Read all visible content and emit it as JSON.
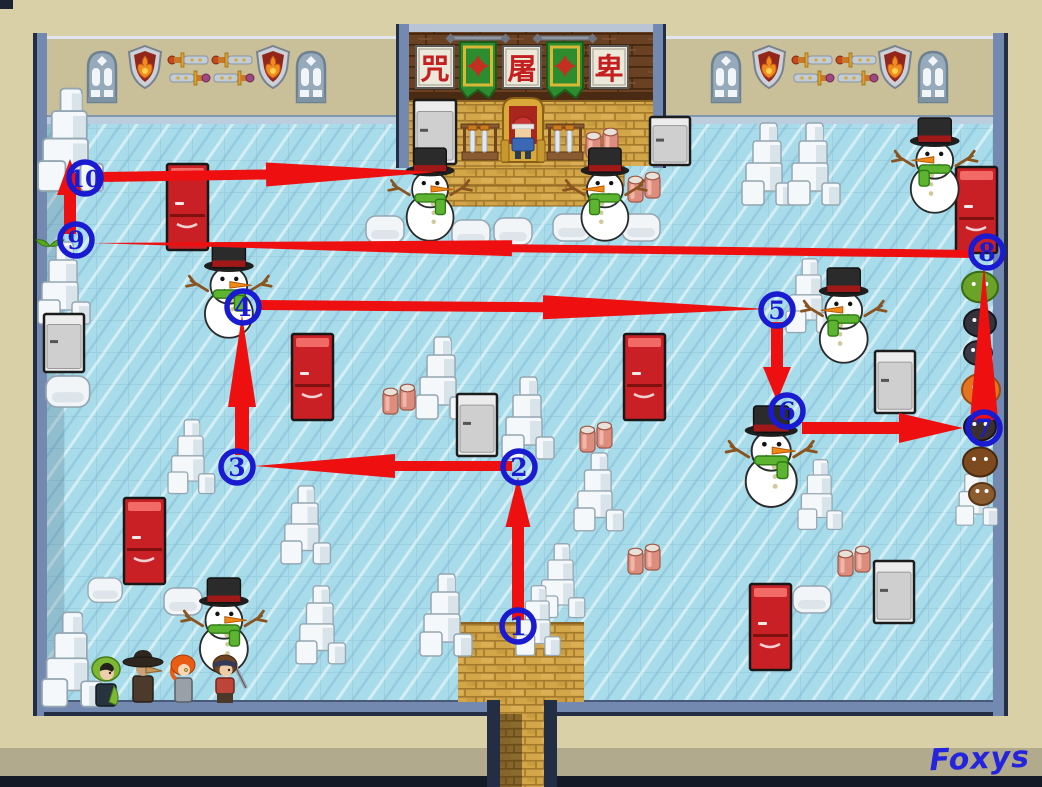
{
  "watermark": "Foxys",
  "palette": {
    "page_bg": "#d9d0a8",
    "navy": "#1c2433",
    "navy2": "#232e45",
    "wall_tan": "#c9bf98",
    "slate": "#7389b0",
    "slate_dark": "#49597a",
    "trim": "#bccede",
    "floor": "#a9dcea",
    "band_gray": "#b2aa8c",
    "route_red": "#ee1010",
    "marker_blue": "#1a1ad0",
    "watermark_blue": "#2424dd",
    "fridge_red": "#c92026",
    "ice_white": "#f4f8fa",
    "gold": "#d2a548",
    "wood": "#6b4123",
    "banner_green": "#2d8c2d",
    "scarf_green": "#5cb430"
  },
  "throne_room": {
    "signs": [
      "咒",
      "屠",
      "卑"
    ]
  },
  "wall_decor": {
    "order": [
      "window",
      "shield",
      "swords",
      "swords",
      "shield",
      "window"
    ],
    "left_x": [
      86,
      127,
      167,
      211,
      255,
      295
    ],
    "right_x": [
      710,
      751,
      791,
      835,
      877,
      917
    ],
    "y": 45
  },
  "route": {
    "color": "#ee1010",
    "marker_color": "#1a1ad0",
    "waypoints": [
      {
        "n": "1",
        "x": 518,
        "y": 626
      },
      {
        "n": "2",
        "x": 519,
        "y": 467
      },
      {
        "n": "3",
        "x": 237,
        "y": 467
      },
      {
        "n": "4",
        "x": 243,
        "y": 307
      },
      {
        "n": "5",
        "x": 777,
        "y": 310
      },
      {
        "n": "6",
        "x": 787,
        "y": 411
      },
      {
        "n": "7",
        "x": 984,
        "y": 428
      },
      {
        "n": "8",
        "x": 987,
        "y": 252
      },
      {
        "n": "9",
        "x": 76,
        "y": 240
      },
      {
        "n": "10",
        "x": 85,
        "y": 178
      }
    ],
    "segments": [
      {
        "name": "1-2",
        "x1": 518,
        "y1": 620,
        "x2": 518,
        "y2": 477,
        "w": 12,
        "hl": 50,
        "hw": 25
      },
      {
        "name": "2-3",
        "x1": 512,
        "y1": 466,
        "x2": 255,
        "y2": 466,
        "w": 10,
        "hl": 140,
        "hw": 24
      },
      {
        "name": "3-4",
        "x1": 242,
        "y1": 455,
        "x2": 242,
        "y2": 315,
        "w": 14,
        "hl": 92,
        "hw": 28
      },
      {
        "name": "4-5",
        "x1": 258,
        "y1": 305,
        "x2": 768,
        "y2": 309,
        "w": 10,
        "hl": 225,
        "hw": 24
      },
      {
        "name": "5-6",
        "x1": 777,
        "y1": 322,
        "x2": 777,
        "y2": 401,
        "w": 12,
        "hl": 34,
        "hw": 28
      },
      {
        "name": "6-7",
        "x1": 802,
        "y1": 428,
        "x2": 963,
        "y2": 428,
        "w": 12,
        "hl": 64,
        "hw": 30
      },
      {
        "name": "7-8",
        "x1": 984,
        "y1": 420,
        "x2": 984,
        "y2": 264,
        "w": 20,
        "hl": 150,
        "hw": 27
      },
      {
        "name": "8-9",
        "x1": 974,
        "y1": 254,
        "x2": 92,
        "y2": 243,
        "w": 8,
        "hl": 420,
        "hw": 16
      },
      {
        "name": "9-10",
        "x1": 70,
        "y1": 234,
        "x2": 70,
        "y2": 159,
        "w": 12,
        "hl": 36,
        "hw": 26
      },
      {
        "name": "10-end",
        "x1": 100,
        "y1": 177,
        "x2": 438,
        "y2": 172,
        "w": 10,
        "hl": 172,
        "hw": 24
      }
    ]
  },
  "scenery": {
    "snowmen": [
      [
        395,
        148,
        0.9,
        0
      ],
      [
        568,
        148,
        0.9,
        1
      ],
      [
        193,
        243,
        0.92,
        0
      ],
      [
        897,
        118,
        0.92,
        1
      ],
      [
        806,
        268,
        0.92,
        1
      ],
      [
        733,
        406,
        0.98,
        0
      ],
      [
        188,
        578,
        0.92,
        0
      ]
    ],
    "ice_pillars": [
      [
        38,
        86,
        1.25
      ],
      [
        38,
        240,
        1.0
      ],
      [
        168,
        418,
        0.9
      ],
      [
        281,
        484,
        0.95
      ],
      [
        296,
        584,
        0.95
      ],
      [
        42,
        610,
        1.15
      ],
      [
        416,
        335,
        1.0
      ],
      [
        502,
        375,
        1.0
      ],
      [
        574,
        451,
        0.95
      ],
      [
        538,
        542,
        0.9
      ],
      [
        420,
        572,
        1.0
      ],
      [
        516,
        584,
        0.85
      ],
      [
        742,
        121,
        1.0
      ],
      [
        788,
        121,
        1.0
      ],
      [
        786,
        257,
        0.9
      ],
      [
        798,
        458,
        0.85
      ],
      [
        956,
        458,
        0.8
      ]
    ],
    "boulders": [
      [
        366,
        216,
        1
      ],
      [
        452,
        220,
        1
      ],
      [
        494,
        218,
        1
      ],
      [
        553,
        214,
        1
      ],
      [
        622,
        214,
        1
      ],
      [
        793,
        586,
        1
      ],
      [
        164,
        588,
        1
      ],
      [
        88,
        578,
        0.9
      ],
      [
        46,
        376,
        1.15
      ]
    ],
    "red_fridges": [
      [
        167,
        164
      ],
      [
        292,
        334
      ],
      [
        624,
        334
      ],
      [
        956,
        167
      ],
      [
        124,
        498
      ],
      [
        750,
        584
      ]
    ],
    "white_fridges": [
      [
        414,
        100,
        42,
        64
      ],
      [
        650,
        117,
        40,
        48
      ],
      [
        44,
        314,
        40,
        58
      ],
      [
        457,
        394,
        40,
        62
      ],
      [
        875,
        351,
        40,
        62
      ],
      [
        874,
        561,
        40,
        62
      ]
    ],
    "can_pairs": [
      [
        586,
        128
      ],
      [
        628,
        172
      ],
      [
        383,
        384
      ],
      [
        580,
        422
      ],
      [
        628,
        544
      ],
      [
        838,
        546
      ]
    ],
    "sprout": [
      50,
      240
    ],
    "mobs": [
      {
        "x": 980,
        "y": 287,
        "r": 18,
        "c": "#6aa22a",
        "d": "#3a6a12"
      },
      {
        "x": 980,
        "y": 323,
        "r": 16,
        "c": "#34323a",
        "d": "#17161c"
      },
      {
        "x": 978,
        "y": 353,
        "r": 14,
        "c": "#3c3a44",
        "d": "#1a1920"
      },
      {
        "x": 981,
        "y": 390,
        "r": 19,
        "c": "#e6731f",
        "d": "#9c4a10"
      },
      {
        "x": 980,
        "y": 427,
        "r": 16,
        "c": "#3a3030",
        "d": "#1c1414"
      },
      {
        "x": 980,
        "y": 462,
        "r": 17,
        "c": "#7c4a1e",
        "d": "#46280c"
      },
      {
        "x": 982,
        "y": 494,
        "r": 13,
        "c": "#8a5c30",
        "d": "#553618"
      }
    ],
    "players": [
      {
        "kind": "green-hood",
        "x": 90,
        "y": 658
      },
      {
        "kind": "plague-doctor",
        "x": 124,
        "y": 652
      },
      {
        "kind": "orange-hair",
        "x": 170,
        "y": 656
      },
      {
        "kind": "bandana-sword",
        "x": 208,
        "y": 656
      }
    ]
  }
}
